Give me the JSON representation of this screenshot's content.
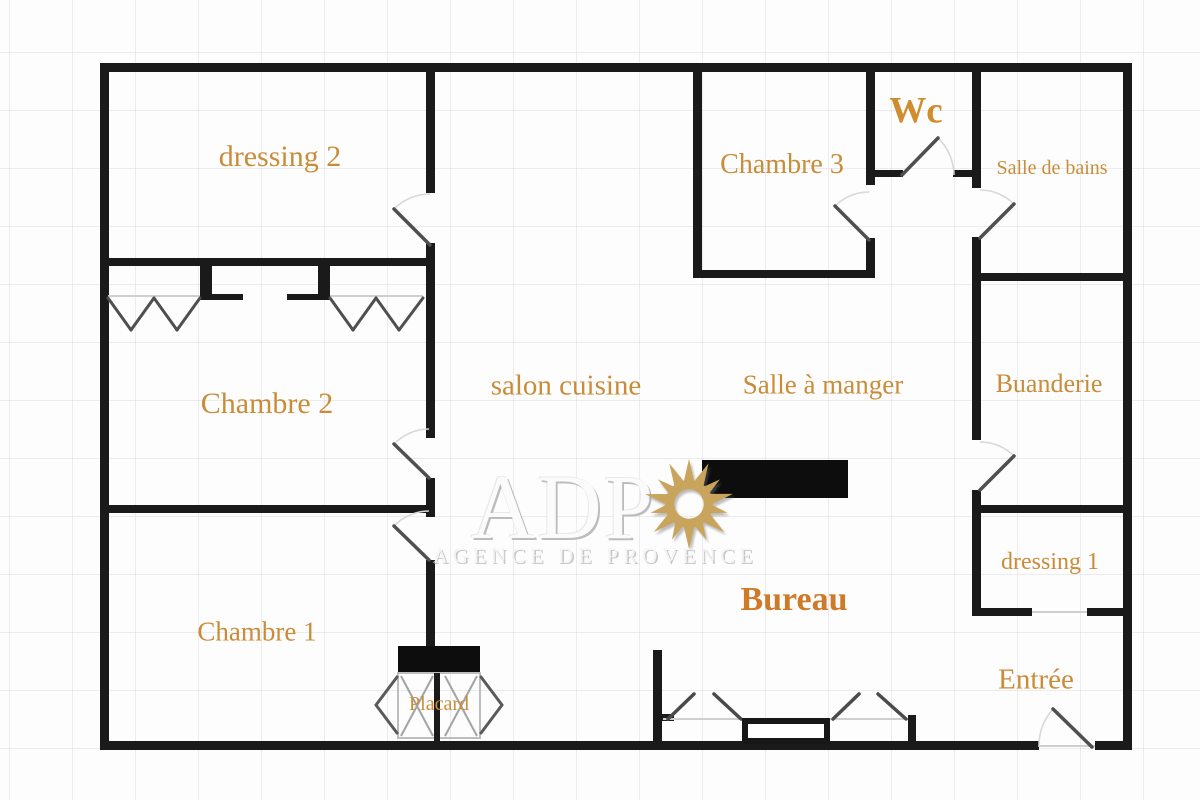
{
  "plan": {
    "title": "Floor plan",
    "rooms": [
      {
        "id": "dressing-2",
        "label": "dressing 2"
      },
      {
        "id": "chambre-3",
        "label": "Chambre 3"
      },
      {
        "id": "wc",
        "label": "Wc"
      },
      {
        "id": "salle-de-bains",
        "label": "Salle de bains"
      },
      {
        "id": "chambre-2",
        "label": "Chambre 2"
      },
      {
        "id": "salon-cuisine",
        "label": "salon cuisine"
      },
      {
        "id": "salle-a-manger",
        "label": "Salle à manger"
      },
      {
        "id": "buanderie",
        "label": "Buanderie"
      },
      {
        "id": "dressing-1",
        "label": "dressing 1"
      },
      {
        "id": "chambre-1",
        "label": "Chambre 1"
      },
      {
        "id": "placard",
        "label": "Placard"
      },
      {
        "id": "bureau",
        "label": "Bureau"
      },
      {
        "id": "entree",
        "label": "Entrée"
      }
    ]
  },
  "watermark": {
    "initials": "ADP",
    "agency": "AGENCE DE PROVENCE",
    "sun_icon": "sun-icon"
  },
  "colors": {
    "wall": "#1a1a1a",
    "room_label": "#c98c38",
    "bureau_label": "#cf7a28",
    "wc_label": "#cf8d2e",
    "door_leaf": "#4f4f4f",
    "door_arc": "#d8d8d8",
    "sill": "#cfcfcf",
    "watermark_gold": "#c9a45c",
    "watermark_gray": "#d9d9d9",
    "grid": "#ededed",
    "background": "#fdfdfd"
  }
}
